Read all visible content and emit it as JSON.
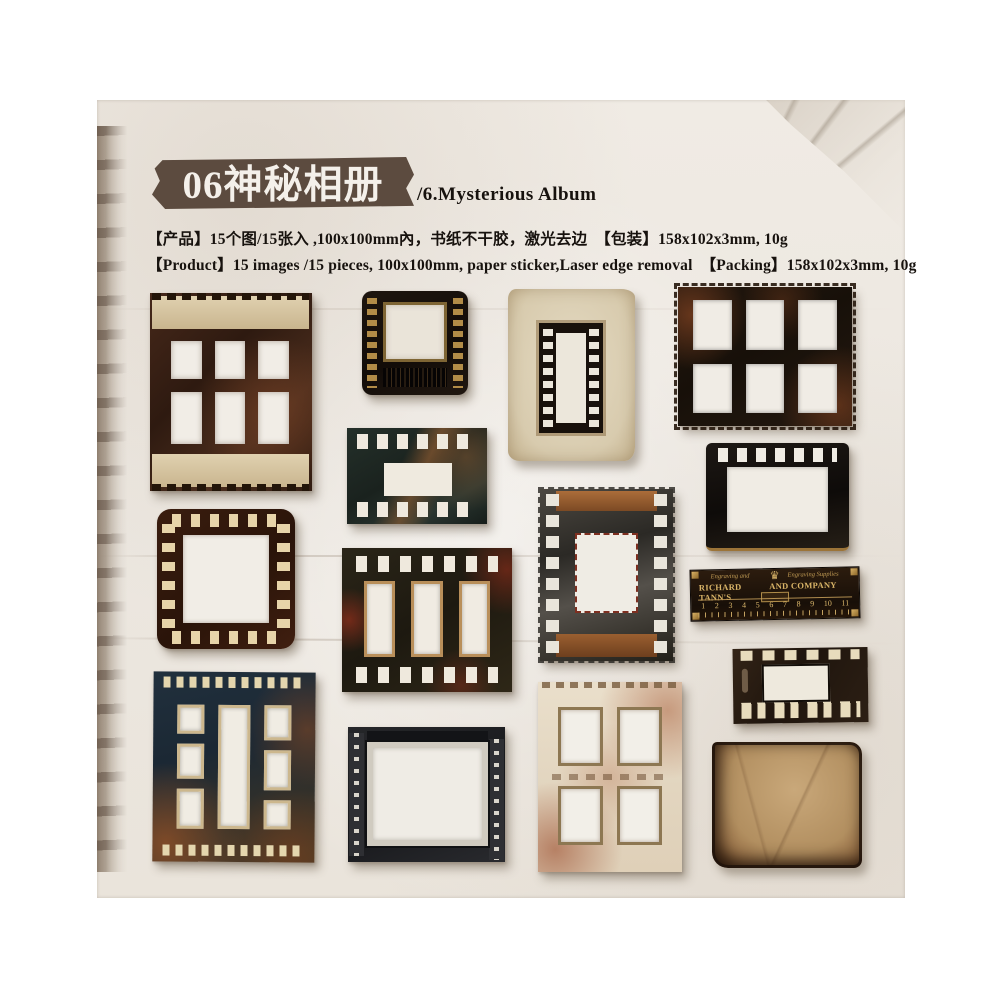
{
  "header": {
    "label_title": "06神秘相册",
    "subtitle": "/6.Mysterious Album",
    "info_cn": "【产品】15个图/15张入 ,100x100mm內，书纸不干胶，激光去边　【包装】158x102x3mm, 10g",
    "info_en": "【Product】15 images /15 pieces, 100x100mm, paper sticker,Laser edge removal　【Packing】158x102x3mm, 10g"
  },
  "ruler": {
    "script_left": "Engraving and",
    "script_right": "Engraving Supplies",
    "name_left": "RICHARD TANN'S",
    "name_right": "AND COMPANY LTD.",
    "crown_icon": "crown",
    "numbers": [
      "1",
      "2",
      "3",
      "4",
      "5",
      "6",
      "7",
      "8",
      "9",
      "10",
      "11"
    ]
  },
  "palette": {
    "page_margin": "#ffffff",
    "paper_bg": "#efeae3",
    "label_bg": "#5c4b3f",
    "text": "#17120e",
    "dark_frame": "#241710",
    "tape_cream": "#d6c5a0",
    "gold": "#b9924c",
    "rust": "#8a4a28",
    "teal_film": "#24302a",
    "parchment": "#b28f60"
  },
  "stickers": [
    {
      "name": "six-pane-taped-frame",
      "desc": "dark brown frame, six windows, cream tape bands"
    },
    {
      "name": "slide-mount-frame",
      "desc": "black slide mount, gold sprocket columns"
    },
    {
      "name": "paper-mounted-film-frame",
      "desc": "cream aged paper with vertical film frame"
    },
    {
      "name": "serrated-six-window-frame",
      "desc": "rusted black frame, six windows, stamp edges"
    },
    {
      "name": "film-scrap-frame",
      "desc": "teal film scrap, sprocket rows top and bottom"
    },
    {
      "name": "dashed-border-frame",
      "desc": "maroon square frame with cream dash border"
    },
    {
      "name": "vertical-filmstrip-frame",
      "desc": "distressed metal filmstrip, copper bands"
    },
    {
      "name": "glossy-black-frame",
      "desc": "glossy black frame, top sprockets, gilt bottom edge"
    },
    {
      "name": "richard-tanns-ruler",
      "desc": "black and gold advertising ruler"
    },
    {
      "name": "three-slot-film-frame",
      "desc": "dark film frame with three vertical windows"
    },
    {
      "name": "small-sprocket-frame",
      "desc": "small dark frame with cream sprocket squares"
    },
    {
      "name": "seven-window-frame",
      "desc": "teal and rust frame with seven windows"
    },
    {
      "name": "white-border-frame",
      "desc": "black frame with distressed white inner border"
    },
    {
      "name": "four-pane-rust-frame",
      "desc": "pale rust-stained frame with four windows"
    },
    {
      "name": "burnt-parchment",
      "desc": "aged parchment square with charred edges"
    }
  ]
}
